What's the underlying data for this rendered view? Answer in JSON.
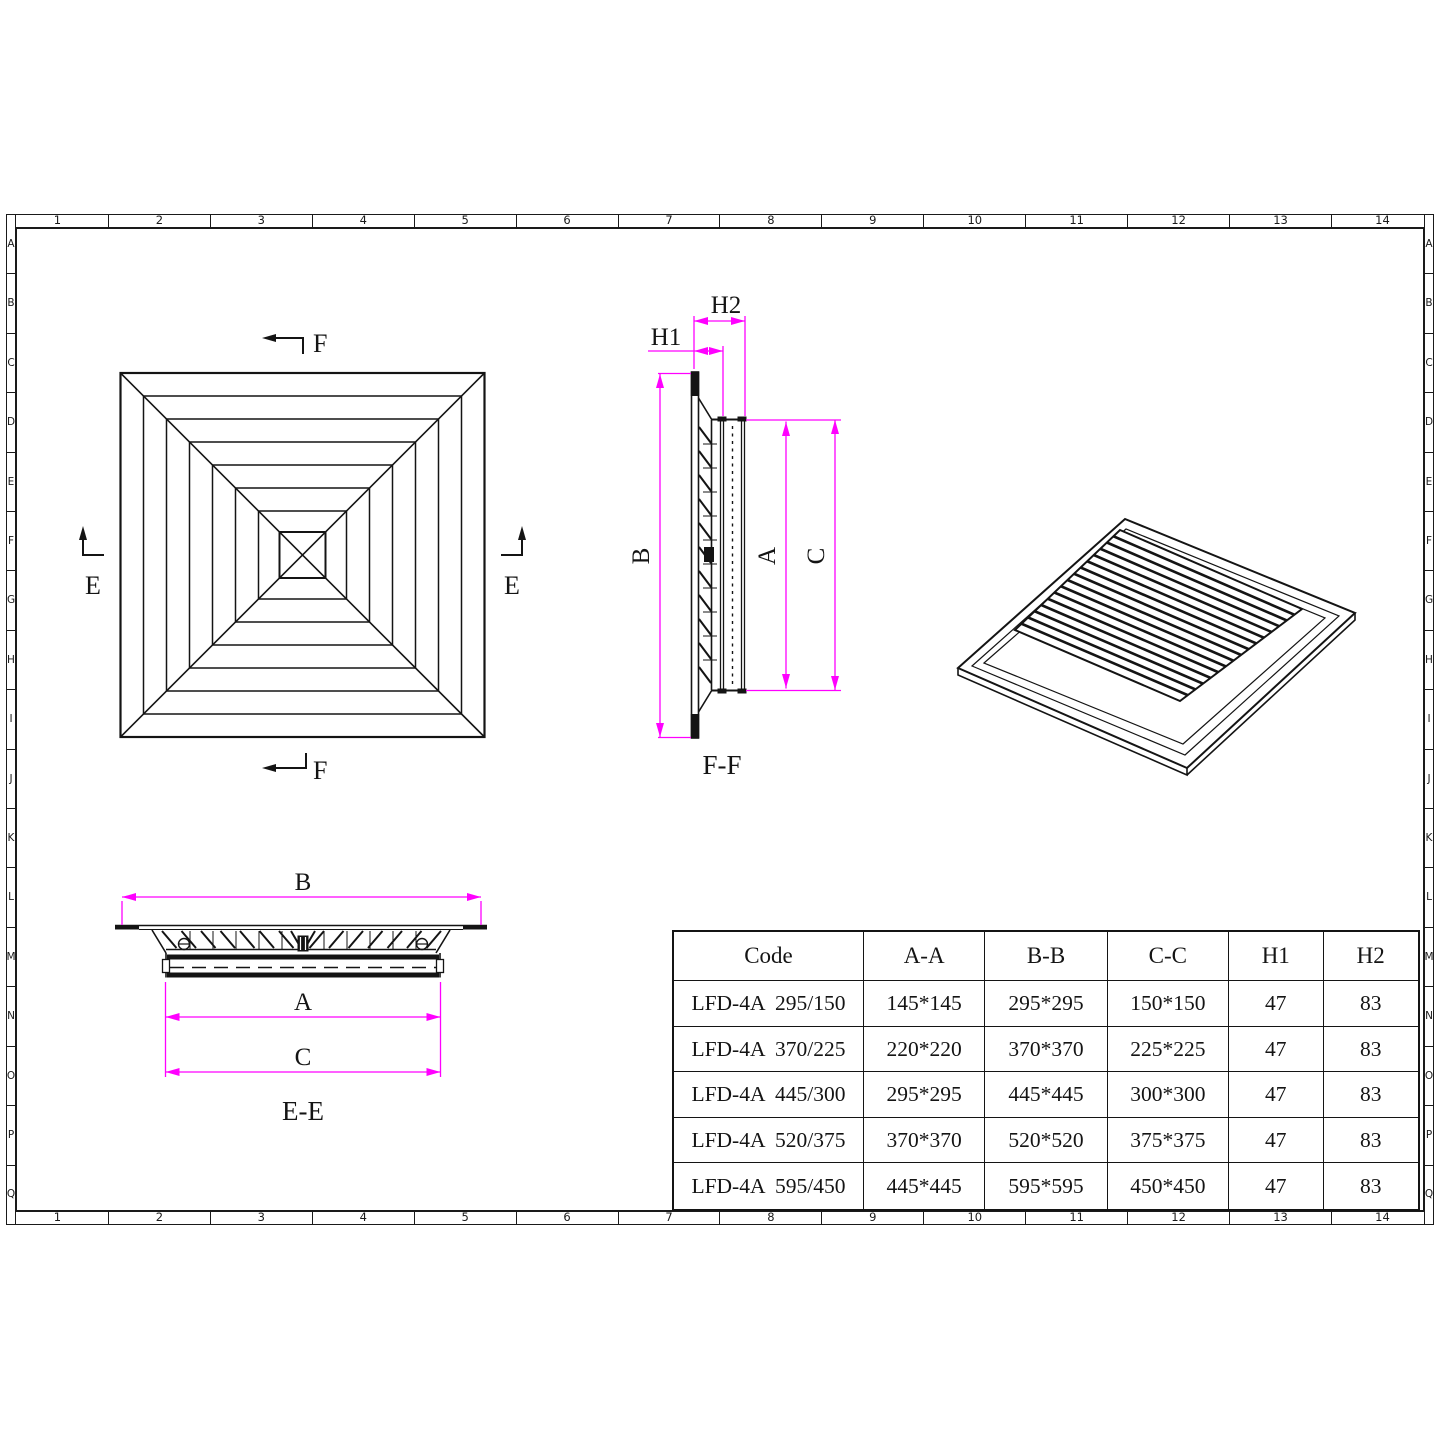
{
  "sheet": {
    "bg": "#ffffff",
    "line_color": "#141414",
    "dim_color": "#ff00ff"
  },
  "grid": {
    "columns": [
      "1",
      "2",
      "3",
      "4",
      "5",
      "6",
      "7",
      "8",
      "9",
      "10",
      "11",
      "12",
      "13",
      "14"
    ],
    "rows": [
      "A",
      "B",
      "C",
      "D",
      "E",
      "F",
      "G",
      "H",
      "I",
      "J",
      "K",
      "L",
      "M",
      "N",
      "O",
      "P",
      "Q"
    ]
  },
  "plan_view": {
    "marker_f_top": "F",
    "marker_f_bottom": "F",
    "marker_e_left": "E",
    "marker_e_right": "E"
  },
  "section_ff": {
    "title": "F-F",
    "dim_b": "B",
    "dim_a": "A",
    "dim_c": "C",
    "dim_h1": "H1",
    "dim_h2": "H2"
  },
  "section_ee": {
    "title": "E-E",
    "dim_b": "B",
    "dim_a": "A",
    "dim_c": "C"
  },
  "table": {
    "headers": [
      "Code",
      "A-A",
      "B-B",
      "C-C",
      "H1",
      "H2"
    ],
    "rows": [
      [
        "LFD-4A  295/150",
        "145*145",
        "295*295",
        "150*150",
        "47",
        "83"
      ],
      [
        "LFD-4A  370/225",
        "220*220",
        "370*370",
        "225*225",
        "47",
        "83"
      ],
      [
        "LFD-4A  445/300",
        "295*295",
        "445*445",
        "300*300",
        "47",
        "83"
      ],
      [
        "LFD-4A  520/375",
        "370*370",
        "520*520",
        "375*375",
        "47",
        "83"
      ],
      [
        "LFD-4A  595/450",
        "445*445",
        "595*595",
        "450*450",
        "47",
        "83"
      ]
    ]
  }
}
